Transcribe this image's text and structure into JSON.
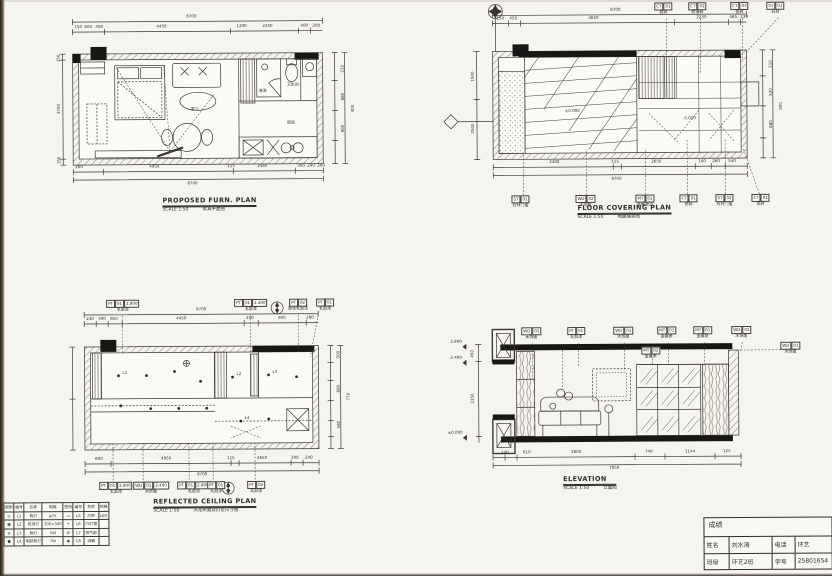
{
  "sheet": {
    "paper": "#f6f4ee",
    "ink": "#2e2c29"
  },
  "furn_plan": {
    "title": "PROPOSED FURN. PLAN",
    "scale": "SCALE 1:50",
    "title_cn": "家具平面图",
    "dim_top_total": "8700",
    "dims_top": [
      "150",
      "600",
      "300",
      "4450",
      "1200",
      "2250",
      "400",
      "200"
    ],
    "dim_bottom_total": "8700",
    "dims_bottom": [
      "200",
      "4950",
      "115",
      "2460",
      "300",
      "240",
      "200"
    ],
    "dims_left": [
      "150",
      "3700",
      "150"
    ],
    "dims_right": [
      "210",
      "520",
      "880",
      "900",
      "400",
      "250"
    ],
    "labels": {
      "coffee_table": "茶几",
      "kitchen": "厨房",
      "shower": "淋浴",
      "wc": "卫生间"
    }
  },
  "covering_plan": {
    "title": "FLOOR COVERING PLAN",
    "scale": "SCALE 1:50",
    "title_cn": "地面铺装图",
    "dim_top_total": "8700",
    "dims_top": [
      "150",
      "450",
      "4650",
      "2250",
      "465",
      "120"
    ],
    "dim_bottom_total": "8700",
    "dims_bottom": [
      "2400",
      "115",
      "2650",
      "140",
      "260",
      "540"
    ],
    "dims_left": [
      "1500",
      "2500"
    ],
    "dims_right": [
      "210",
      "520",
      "880",
      "900"
    ],
    "level_main": "±0.000",
    "level_bath": "-0.050",
    "tags_top": [
      {
        "code": "CT",
        "num": "01",
        "label": "瓷砖"
      },
      {
        "code": "CT",
        "num": "02",
        "label": "防滑砖"
      },
      {
        "code": "CT",
        "num": "03",
        "label": "瓷砖"
      },
      {
        "code": "ST",
        "num": "01",
        "label": "石材"
      }
    ],
    "tags_bottom": [
      {
        "code": "ST",
        "num": "01",
        "label": "石材门槛"
      },
      {
        "code": "WD",
        "num": "02",
        "label": "木地板"
      },
      {
        "code": "MT",
        "num": "01",
        "label": "金属收边"
      },
      {
        "code": "CT",
        "num": "01",
        "label": "瓷砖"
      },
      {
        "code": "ST",
        "num": "02",
        "label": "石材门槛"
      },
      {
        "code": "CT",
        "num": "01",
        "label": "瓷砖"
      }
    ]
  },
  "ceiling_plan": {
    "title": "REFLECTED CEILING PLAN",
    "scale": "SCALE 1:50",
    "title_cn": "天花布置及灯位尺寸图",
    "dim_top_total": "8700",
    "dims_top": [
      "240",
      "300",
      "850",
      "4450",
      "450",
      "845",
      "280"
    ],
    "dim_bottom_total": "8700",
    "dims_bottom": [
      "600",
      "4950",
      "115",
      "2650",
      "300",
      "240"
    ],
    "dims_right": [
      "120",
      "250",
      "500",
      "880",
      "580",
      "770",
      "420",
      "240"
    ],
    "tags_top": [
      {
        "code": "PT",
        "num": "01",
        "level": "2.800",
        "label": "乳胶漆"
      },
      {
        "code": "PT",
        "num": "01",
        "level": "2.400",
        "label": "乳胶漆"
      },
      {
        "code": "PT",
        "num": "02",
        "level": "2.400",
        "label": "防水乳胶漆"
      },
      {
        "code": "PT",
        "num": "01",
        "level": "2.400",
        "label": "乳胶漆"
      }
    ],
    "tags_bottom": [
      {
        "code": "PT",
        "num": "01",
        "level": "2.800",
        "label": "乳胶漆"
      },
      {
        "code": "WD",
        "num": "01",
        "level": "2.400",
        "label": "木饰面"
      },
      {
        "code": "PT",
        "num": "01",
        "level": "2.800",
        "label": "乳胶漆"
      },
      {
        "code": "PT",
        "num": "01",
        "level": "2.400",
        "label": "乳胶漆"
      },
      {
        "code": "PT",
        "num": "02",
        "level": "2.400",
        "label": "乳胶漆"
      }
    ],
    "lights": [
      "L1",
      "L2",
      "L3",
      "L4"
    ]
  },
  "elevation": {
    "title": "ELEVATION",
    "scale": "SCALE 1:50",
    "title_cn": "立面图",
    "dim_bottom_total": "7950",
    "dims_bottom": [
      "140",
      "610",
      "3800",
      "740",
      "1144",
      "125"
    ],
    "dims_left": [
      "450",
      "2350"
    ],
    "levels": [
      "2.800",
      "2.400",
      "±0.000"
    ],
    "tags_top": [
      {
        "code": "WD",
        "num": "01",
        "label": "木饰面"
      },
      {
        "code": "PT",
        "num": "01",
        "label": "乳胶漆"
      },
      {
        "code": "WD",
        "num": "01",
        "label": "木饰面"
      },
      {
        "code": "MT",
        "num": "01",
        "label": "金属条"
      },
      {
        "code": "MT",
        "num": "01",
        "label": "金属条"
      },
      {
        "code": "WD",
        "num": "01",
        "label": "木饰面"
      }
    ],
    "tag_mid": {
      "code": "MT",
      "num": "02",
      "label": "金属条"
    },
    "tag_right": {
      "code": "WD",
      "num": "01",
      "label": "木饰面"
    }
  },
  "legend": {
    "headers": [
      "图例",
      "编号",
      "名称",
      "规格",
      "图例",
      "编号",
      "名称",
      "规格"
    ],
    "rows": [
      [
        "⊙",
        "L1",
        "筒灯",
        "φ75",
        "▭",
        "L5",
        "灯带",
        "LED"
      ],
      [
        "▦",
        "L2",
        "吸顶灯",
        "300×300",
        "━",
        "L6",
        "T5灯管",
        ""
      ],
      [
        "⊖",
        "L3",
        "射灯",
        "5W",
        "☒",
        "L7",
        "排气扇",
        ""
      ],
      [
        "●",
        "L4",
        "明装筒灯",
        "7W",
        "◉",
        "L8",
        "浴霸",
        ""
      ]
    ]
  },
  "title_block": {
    "score_label": "成绩",
    "rows": [
      [
        "姓名",
        "刘水涛",
        "电话",
        "环艺"
      ],
      [
        "班级",
        "环艺2班",
        "学号",
        "25801654"
      ]
    ]
  }
}
